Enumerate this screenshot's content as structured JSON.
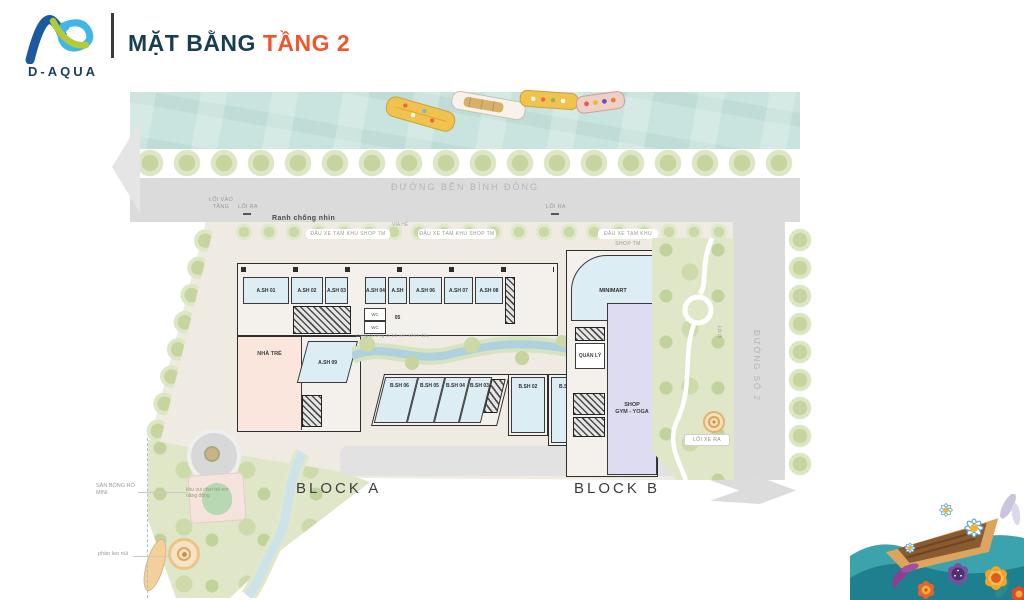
{
  "header": {
    "brand": "D-AQUA",
    "title": "MẶT BẰNG",
    "title_accent": "TẦNG 2"
  },
  "streets": {
    "ben_binh_dong": "ĐƯỜNG BẾN BÌNH ĐÔNG",
    "duong_so_2": "ĐƯỜNG SỐ 2"
  },
  "annotations": {
    "loi_vao_tang": "LỐI VÀO TẦNG",
    "loi_ra": "LỐI RA",
    "ranh": "Ranh chống nhìn",
    "via_he": "VỈA HÈ",
    "parking": "ĐẬU XE TẠM KHU SHOP TM",
    "canal_walk": "Cung đường đi bộ ven kênh đào",
    "loi_xe_ra": "LỐI XE RA",
    "loi_di": "Lối đi"
  },
  "block_a": {
    "label": "BLOCK A",
    "units": [
      "A.SH 01",
      "A.SH 02",
      "A.SH 03",
      "A.SH 04",
      "A.SH 05",
      "A.SH 06",
      "A.SH 07",
      "A.SH 08"
    ],
    "unit9": "A.SH 09",
    "nha_tre": "NHÀ TRẺ",
    "wc": "WC"
  },
  "block_b": {
    "label": "BLOCK B",
    "units": [
      "B.SH 06",
      "B.SH 05",
      "B.SH 04",
      "B.SH 03",
      "B.SH 02",
      "B.SH 01"
    ],
    "minimart": "MINIMART",
    "quan_ly": "QUẢN LÝ",
    "gym_line1": "SHOP",
    "gym_line2": "GYM - YOGA"
  },
  "park": {
    "san_bong": "SÂN BÓNG RỔ MINI",
    "playground": "khu vui chơi trẻ em năng động",
    "leo_nui": "phần leo núi"
  },
  "colors": {
    "title": "#173F4E",
    "accent": "#F2542C",
    "logo_navy": "#1C3E5E",
    "logo_blue": "#41B6E8",
    "logo_green": "#B3CB37",
    "water": "#C9E4DE",
    "road": "#DBDBDB",
    "shop_fill": "#DCEDF4",
    "nursery_fill": "#FBE6DD",
    "gym_fill": "#DEDCF1",
    "park_green": "#DFE7C8"
  }
}
